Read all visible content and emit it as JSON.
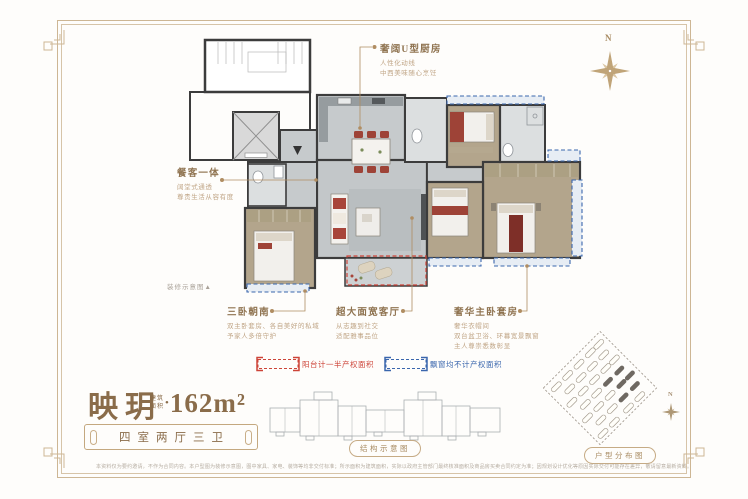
{
  "callouts": {
    "kitchen": {
      "title": "奢阔U型厨房",
      "lines": [
        "人性化动线",
        "中西美味随心烹饪"
      ]
    },
    "dining": {
      "title": "餐客一体",
      "lines": [
        "阔堂式通透",
        "尊贵生活从容有度"
      ]
    },
    "bedrooms": {
      "title": "三卧朝南",
      "lines": [
        "双主卧套房、各自美好的私域",
        "予家人多倍守护"
      ]
    },
    "living": {
      "title": "超大面宽客厅",
      "lines": [
        "从志趣到社交",
        "适配雅事品位"
      ]
    },
    "master": {
      "title": "奢华主卧套房",
      "lines": [
        "奢华衣帽间",
        "双台盆卫浴、环幕宽景飘窗",
        "主人尊崇悉数彰显"
      ]
    }
  },
  "deco_note": "装修示意图▲",
  "legend": {
    "red": {
      "label": "阳台计一半产权面积",
      "color": "#cd4438"
    },
    "blue": {
      "label": "飘窗均不计产权面积",
      "color": "#3a66ad"
    }
  },
  "title_block": {
    "name": "映玥",
    "area_label": "建筑面积",
    "area_bullet": "•",
    "area_value": "162m²",
    "spec": "四室两厅三卫"
  },
  "captions": {
    "structure": "结构示意图",
    "siteplan": "户型分布图"
  },
  "compass": {
    "label": "N"
  },
  "site_compass": {
    "label": "N"
  },
  "disclaimer": "本资料仅为要约邀请，不作为合同内容。本户型图为装修示意图，图中家具、家电、装饰等均非交付标准；所示面积为建筑面积，实际以政府主管部门最终核准面积及商品房买卖合同约定为准；因规划设计优化等原因实际交付可能存在差异，敬请留意最新资料。"
}
